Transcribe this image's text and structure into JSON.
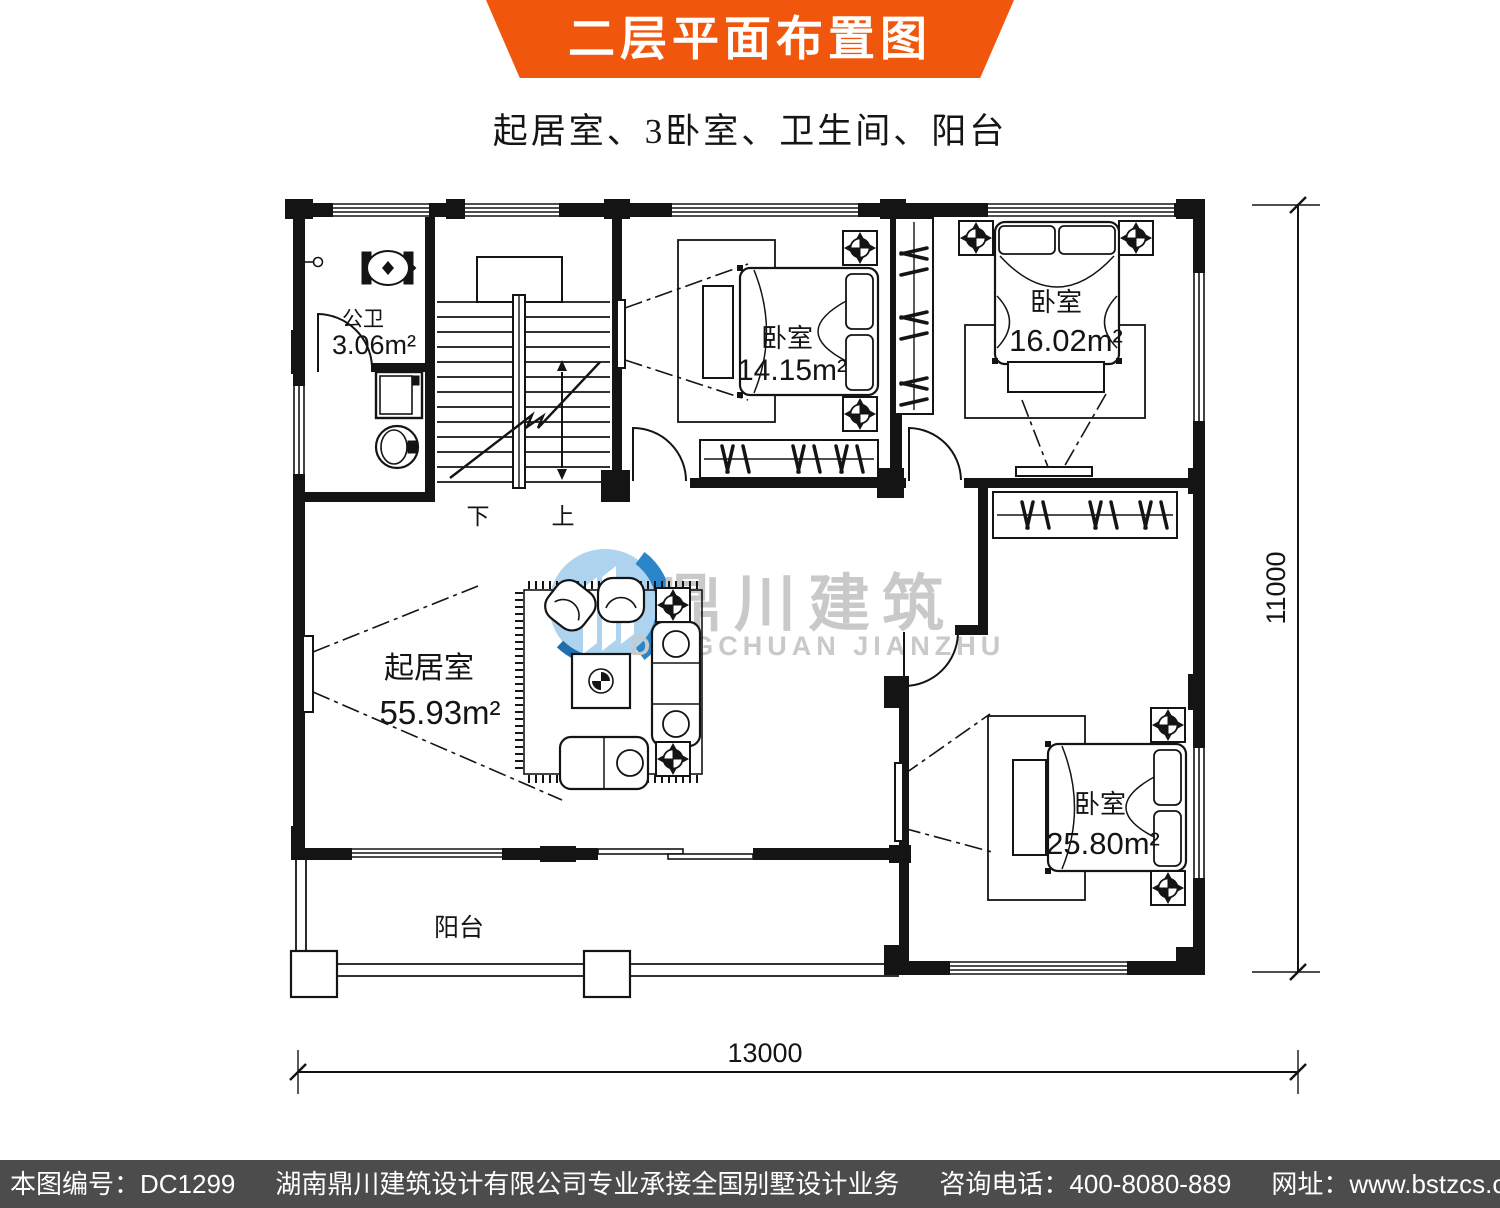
{
  "header": {
    "title": "二层平面布置图"
  },
  "subtitle": "起居室、3卧室、卫生间、阳台",
  "rooms": {
    "bathroom": {
      "name": "公卫",
      "area": "3.06m²"
    },
    "bedroom_top": {
      "name": "卧室",
      "area": "14.15m²"
    },
    "bedroom_right": {
      "name": "卧室",
      "area": "16.02m²"
    },
    "living": {
      "name": "起居室",
      "area": "55.93m²"
    },
    "bedroom_bottom": {
      "name": "卧室",
      "area": "25.80m²"
    },
    "balcony": {
      "name": "阳台"
    }
  },
  "stairs": {
    "down": "下",
    "up": "上"
  },
  "dimensions": {
    "width": "13000",
    "height": "11000"
  },
  "watermark": {
    "brand": "鼎川建筑",
    "brand_latin": "DINGCHUAN JIANZHU"
  },
  "footer": {
    "plan_no": "本图编号：DC1299",
    "company": "湖南鼎川建筑设计有限公司专业承接全国别墅设计业务",
    "phone": "咨询电话：400-8080-889",
    "website": "网址：www.bstzcs.com"
  },
  "colors": {
    "banner": "#f1570c",
    "footer_bg": "#4c4c4c",
    "watermark_gray": "#c9c9c9",
    "logo_blue": "#aed3ee",
    "logo_blue_dark": "#2a86c8",
    "line": "#141414"
  }
}
